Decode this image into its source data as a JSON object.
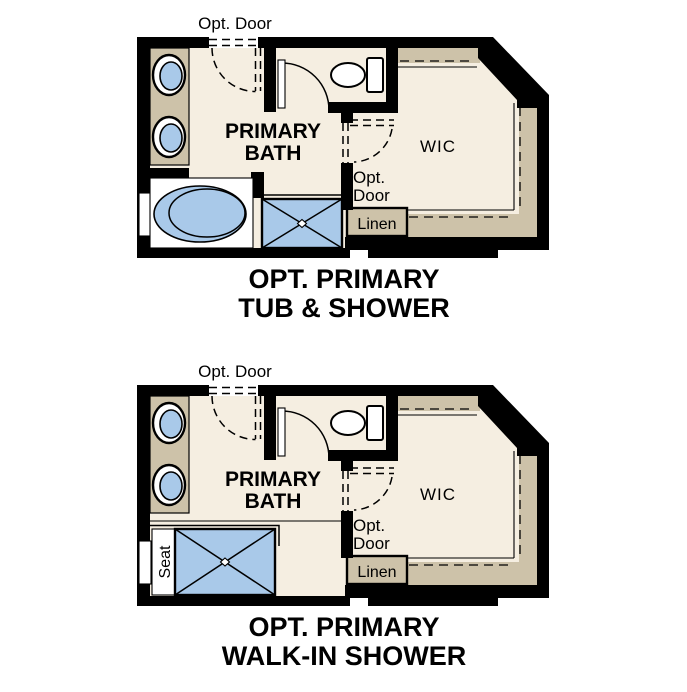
{
  "colors": {
    "wall": "#000000",
    "floor": "#f5eee1",
    "cabinet": "#cdc2a9",
    "fixture": "#a9c9e9",
    "text": "#000000",
    "background": "#ffffff"
  },
  "plans": [
    {
      "caption_line1": "OPT. PRIMARY",
      "caption_line2": "TUB & SHOWER",
      "labels": {
        "opt_door_entry": "Opt. Door",
        "room_line1": "PRIMARY",
        "room_line2": "BATH",
        "closet": "WIC",
        "opt_door_closet_line1": "Opt.",
        "opt_door_closet_line2": "Door",
        "linen": "Linen"
      }
    },
    {
      "caption_line1": "OPT. PRIMARY",
      "caption_line2": "WALK-IN SHOWER",
      "labels": {
        "opt_door_entry": "Opt. Door",
        "room_line1": "PRIMARY",
        "room_line2": "BATH",
        "closet": "WIC",
        "opt_door_closet_line1": "Opt.",
        "opt_door_closet_line2": "Door",
        "linen": "Linen",
        "seat": "Seat"
      }
    }
  ]
}
